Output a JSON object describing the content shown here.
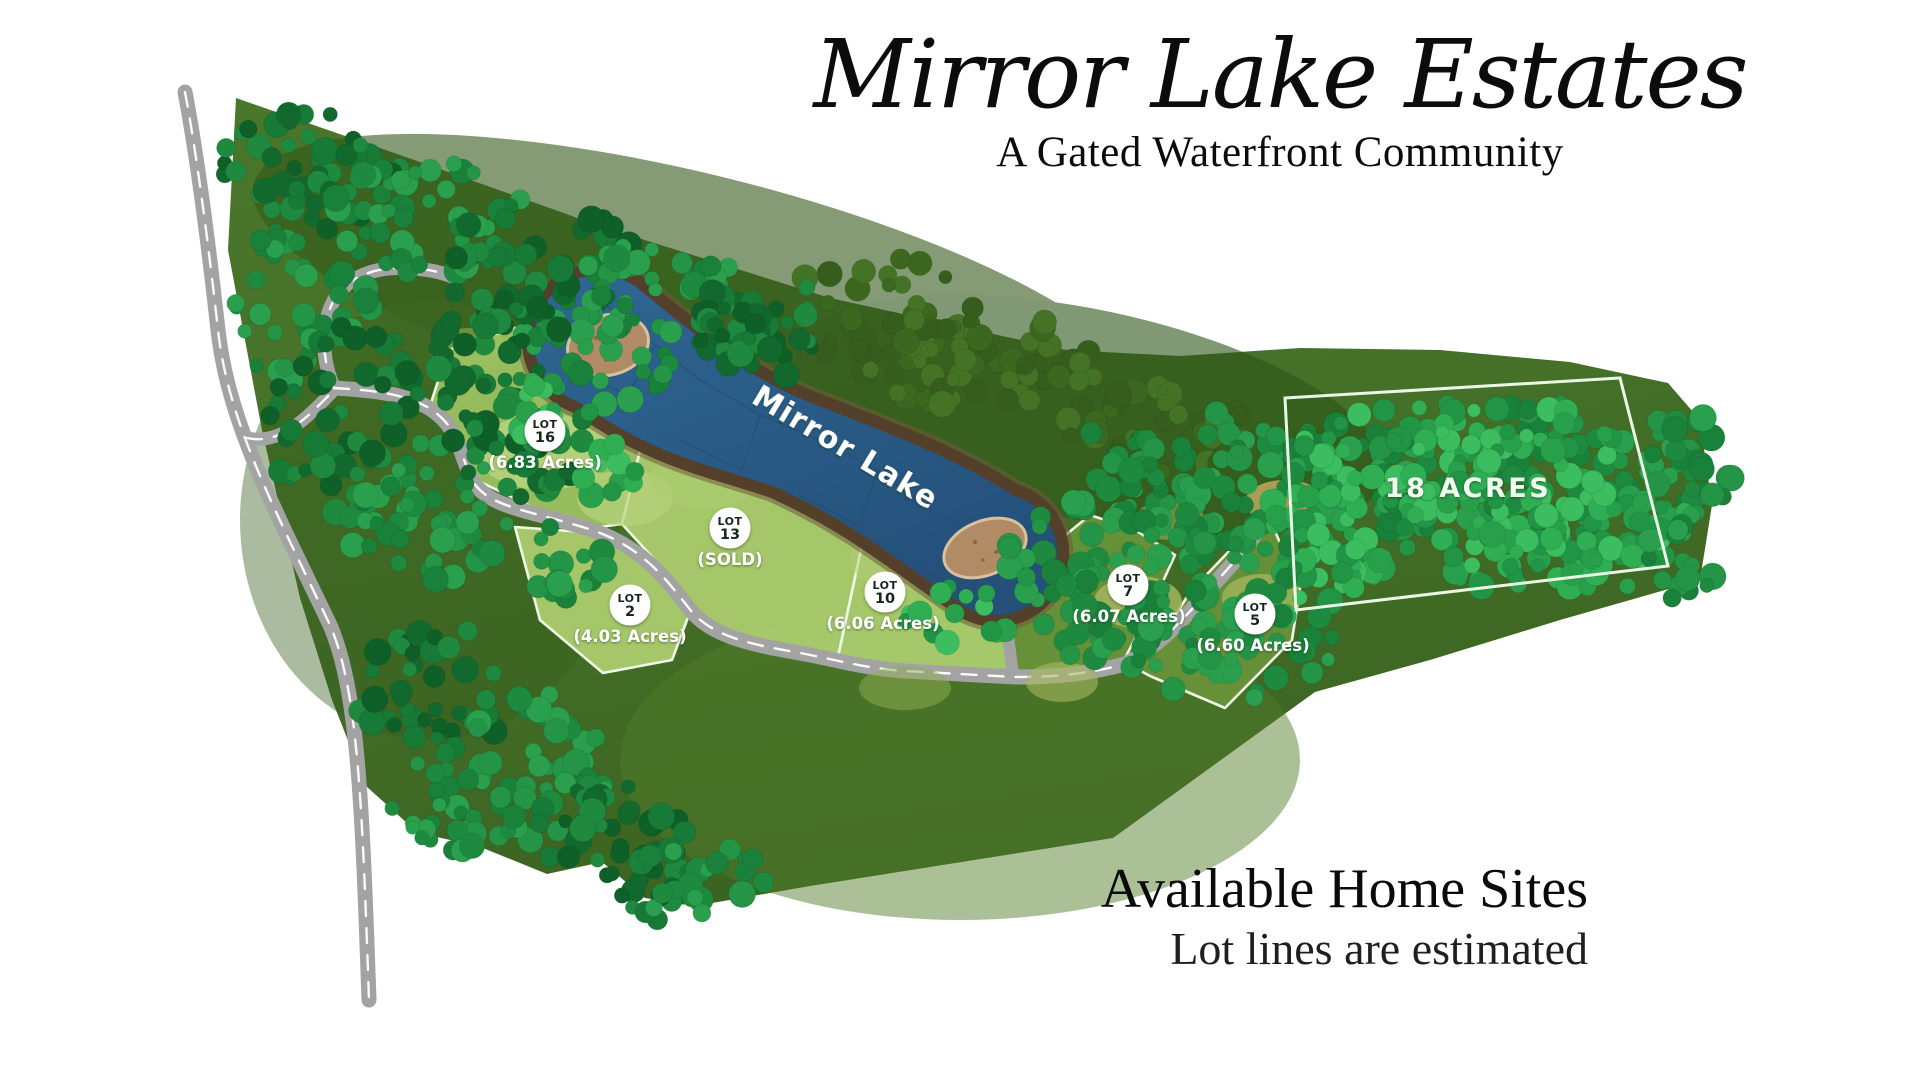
{
  "header": {
    "title": "Mirror Lake Estates",
    "subtitle": "A Gated Waterfront Community"
  },
  "footer": {
    "heading": "Available Home Sites",
    "note": "Lot lines are estimated"
  },
  "map": {
    "lake_label": "Mirror Lake",
    "parcel_label": "18 ACRES",
    "lots": [
      {
        "name": "LOT",
        "number": "16",
        "detail": "(6.83 Acres)"
      },
      {
        "name": "LOT",
        "number": "13",
        "detail": "(SOLD)"
      },
      {
        "name": "LOT",
        "number": "2",
        "detail": "(4.03 Acres)"
      },
      {
        "name": "LOT",
        "number": "10",
        "detail": "(6.06 Acres)"
      },
      {
        "name": "LOT",
        "number": "7",
        "detail": "(6.07 Acres)"
      },
      {
        "name": "LOT",
        "number": "5",
        "detail": "(6.60 Acres)"
      }
    ],
    "colors": {
      "water": "#2b5f8c",
      "shoreline": "#54402a",
      "road": "#a3a3a3",
      "land": "#47712a",
      "lot_grass": "#a8ca6c",
      "tree_green": "#2fae54",
      "boundary_line": "#eef9e6",
      "beach_sand": "#b18a66"
    }
  }
}
